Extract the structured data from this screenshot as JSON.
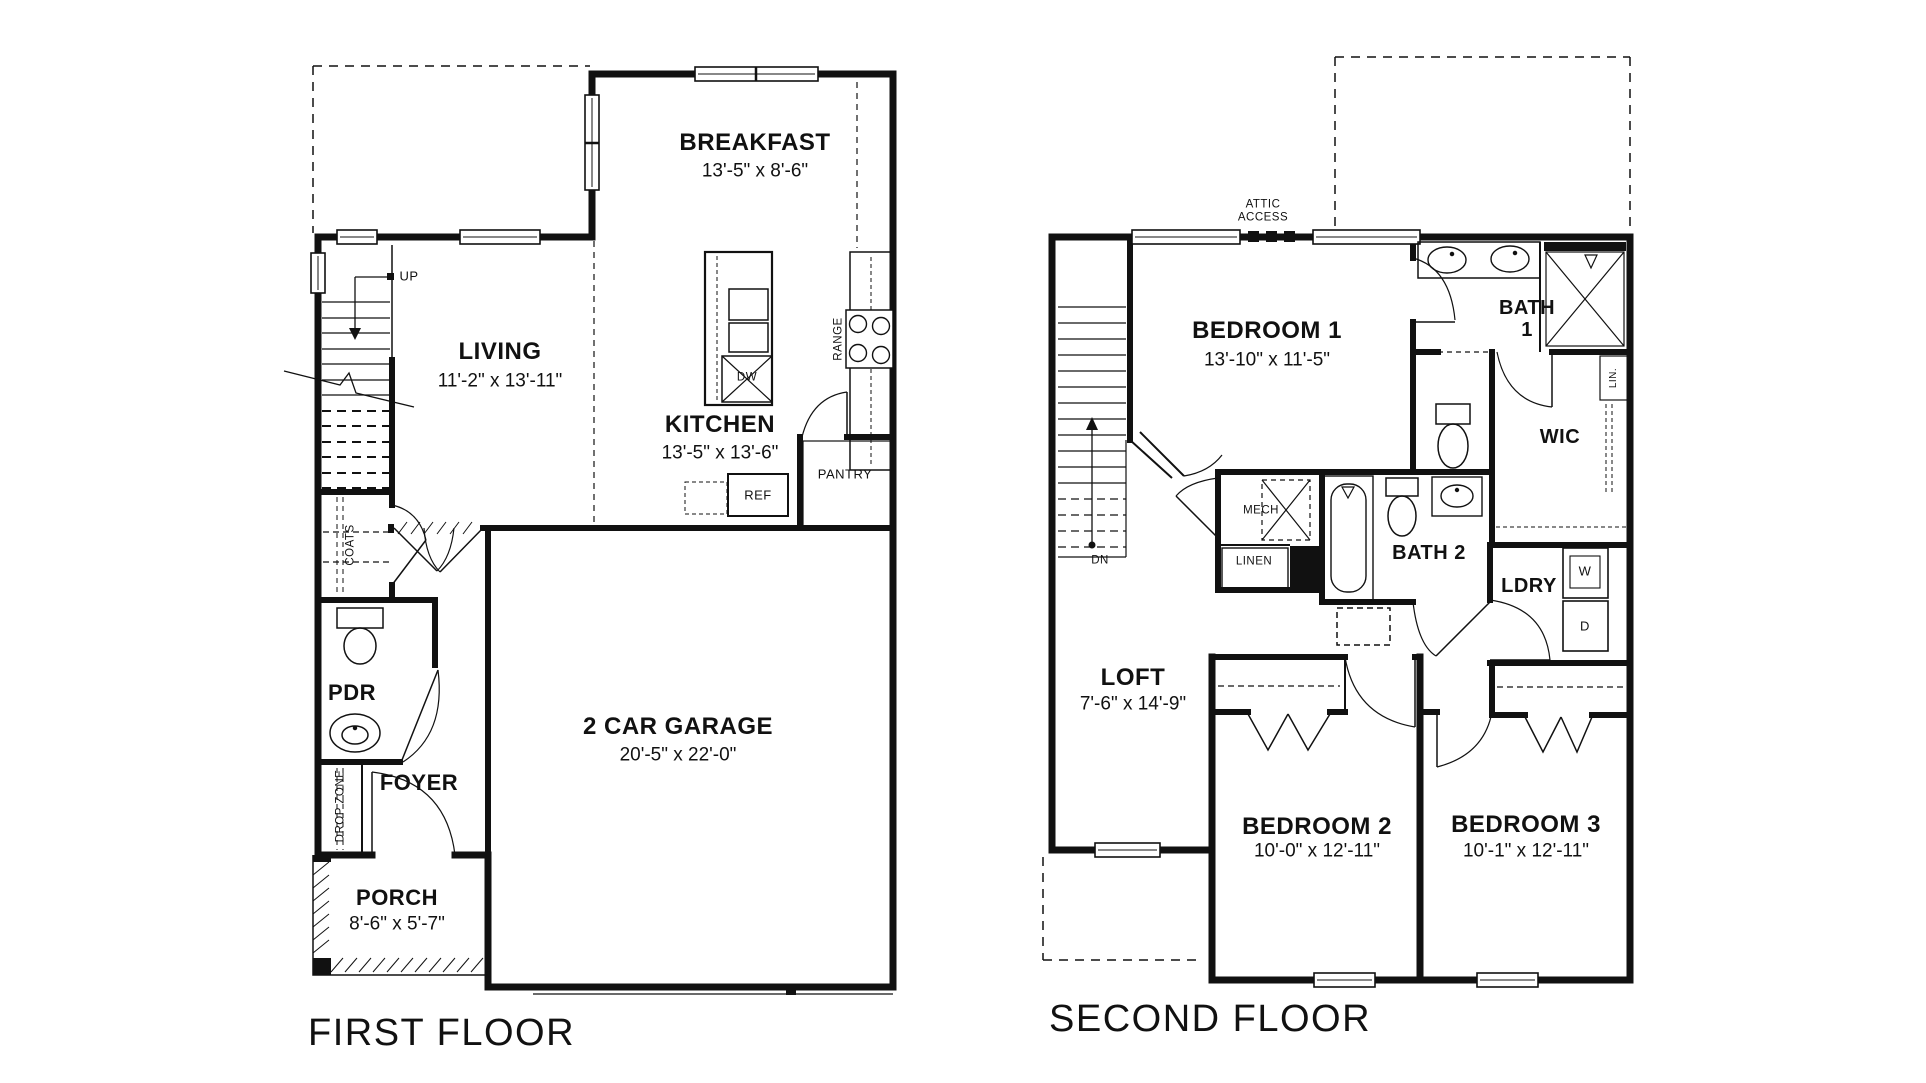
{
  "document": {
    "background": "#ffffff",
    "ink": "#111111"
  },
  "first_floor": {
    "title": "FIRST FLOOR",
    "rooms": {
      "breakfast": {
        "name": "BREAKFAST",
        "dims": "13'-5\" x 8'-6\""
      },
      "living": {
        "name": "LIVING",
        "dims": "11'-2\" x 13'-11\""
      },
      "kitchen": {
        "name": "KITCHEN",
        "dims": "13'-5\" x 13'-6\""
      },
      "pdr": {
        "name": "PDR"
      },
      "foyer": {
        "name": "FOYER"
      },
      "porch": {
        "name": "PORCH",
        "dims": "8'-6\" x 5'-7\""
      },
      "garage": {
        "name": "2 CAR GARAGE",
        "dims": "20'-5\" x 22'-0\""
      }
    },
    "annotations": {
      "up": "UP",
      "coats": "COATS",
      "drop_zone": "DROP ZONE",
      "pantry": "PANTRY",
      "ref": "REF",
      "dw": "DW",
      "range": "RANGE"
    }
  },
  "second_floor": {
    "title": "SECOND FLOOR",
    "rooms": {
      "bedroom1": {
        "name": "BEDROOM 1",
        "dims": "13'-10\" x 11'-5\""
      },
      "bedroom2": {
        "name": "BEDROOM 2",
        "dims": "10'-0\" x 12'-11\""
      },
      "bedroom3": {
        "name": "BEDROOM 3",
        "dims": "10'-1\" x 12'-11\""
      },
      "loft": {
        "name": "LOFT",
        "dims": "7'-6\" x 14'-9\""
      },
      "bath1": {
        "line1": "BATH",
        "line2": "1"
      },
      "bath2": {
        "name": "BATH 2"
      },
      "wic": {
        "name": "WIC"
      },
      "ldry": {
        "name": "LDRY"
      }
    },
    "annotations": {
      "attic_line1": "ATTIC",
      "attic_line2": "ACCESS",
      "dn": "DN",
      "mech": "MECH",
      "linen": "LINEN",
      "lin": "LIN.",
      "washer": "W",
      "dryer": "D"
    }
  }
}
